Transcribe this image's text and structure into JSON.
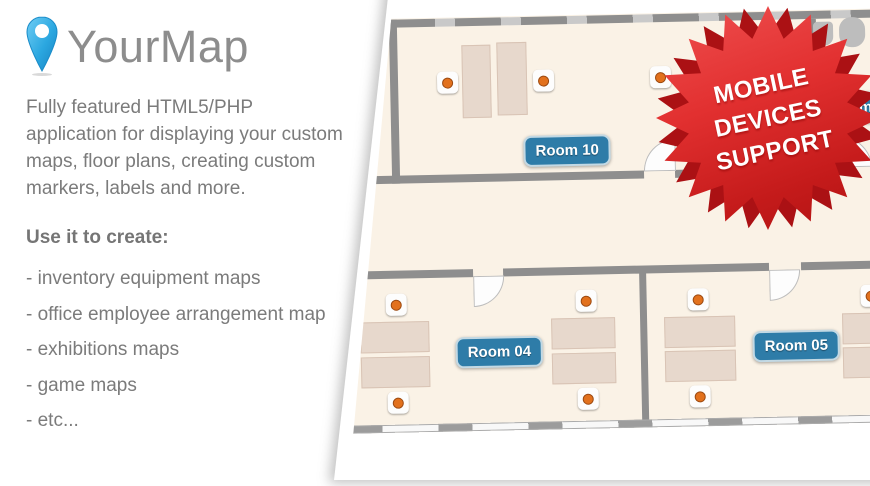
{
  "brand": {
    "name": "YourMap"
  },
  "intro": "Fully featured HTML5/PHP application for displaying your custom maps, floor plans, creating custom markers, labels and more.",
  "use_cases": {
    "heading": "Use it to create:",
    "items": [
      "- inventory equipment maps",
      "- office employee arrangement map",
      "- exhibitions maps",
      "- game maps",
      "- etc..."
    ]
  },
  "starburst": {
    "lines": [
      "MOBILE",
      "DEVICES",
      "SUPPORT"
    ]
  },
  "floor_plan": {
    "rooms": [
      {
        "label": "Room 10"
      },
      {
        "label": "Room 04"
      },
      {
        "label": "Room 05"
      },
      {
        "label": "oms"
      }
    ]
  },
  "colors": {
    "label_blue": "#2e7ca8",
    "marker_orange": "#e2711d",
    "star_red": "#d6231f",
    "floor_cream": "#faf2e6",
    "wall_gray": "#8e8e8e",
    "pin_blue": "#2ba7e0",
    "text_gray": "#7b7b7b"
  }
}
